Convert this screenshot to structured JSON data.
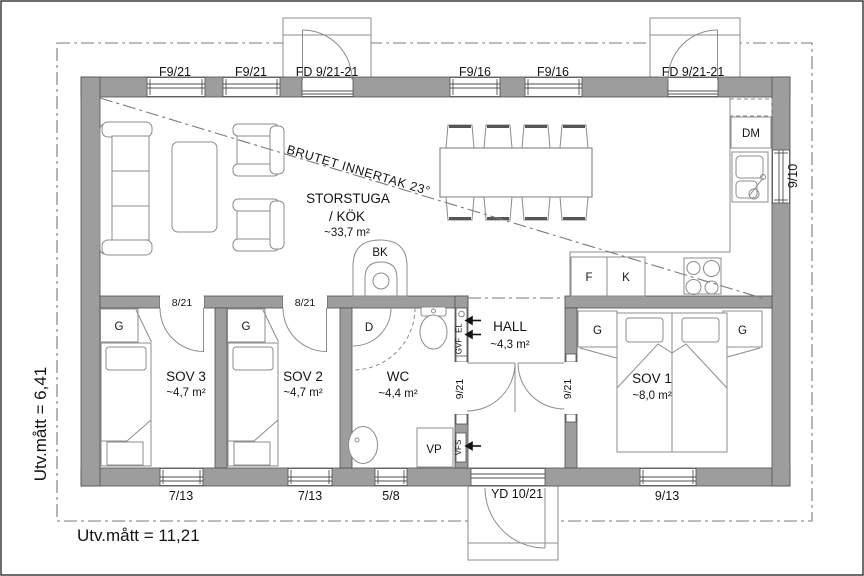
{
  "plan_labels": {
    "outer_width": "Utv.mått = 11,21",
    "outer_height": "Utv.mått = 6,41",
    "ceiling_note": "BRUTET INNERTAK 23°"
  },
  "rooms": {
    "storstuga": {
      "name": "STORSTUGA",
      "name2": "/ KÖK",
      "area": "~33,7 m²"
    },
    "sov3": {
      "name": "SOV 3",
      "area": "~4,7 m²"
    },
    "sov2": {
      "name": "SOV 2",
      "area": "~4,7 m²"
    },
    "wc": {
      "name": "WC",
      "area": "~4,4 m²"
    },
    "hall": {
      "name": "HALL",
      "area": "~4,3 m²"
    },
    "sov1": {
      "name": "SOV 1",
      "area": "~8,0 m²"
    }
  },
  "openings": {
    "top": [
      "F9/21",
      "F9/21",
      "FD 9/21-21",
      "F9/16",
      "F9/16",
      "FD 9/21-21"
    ],
    "bottom": [
      "7/13",
      "7/13",
      "5/8",
      "YD 10/21",
      "9/13"
    ],
    "right": "9/10",
    "sov3_door": "8/21",
    "sov2_door": "8/21",
    "wc_door": "9/21",
    "sov1_door": "9/21"
  },
  "fixtures": {
    "wardrobe": "G",
    "shower": "D",
    "heat_pump": "VP",
    "dishwasher": "DM",
    "stove_chimney": "BK",
    "fridge": "F",
    "freezer": "K",
    "vent_gvf": "GVF",
    "vent_el": "EL",
    "vent_vfs": "VFS"
  },
  "colors": {
    "wall": "#9d9d9d",
    "wall_edge": "#4f4f4f",
    "furniture_line": "#8c8c8c",
    "dash_line": "#7a7a7a",
    "text": "#141414",
    "background": "#ffffff"
  }
}
